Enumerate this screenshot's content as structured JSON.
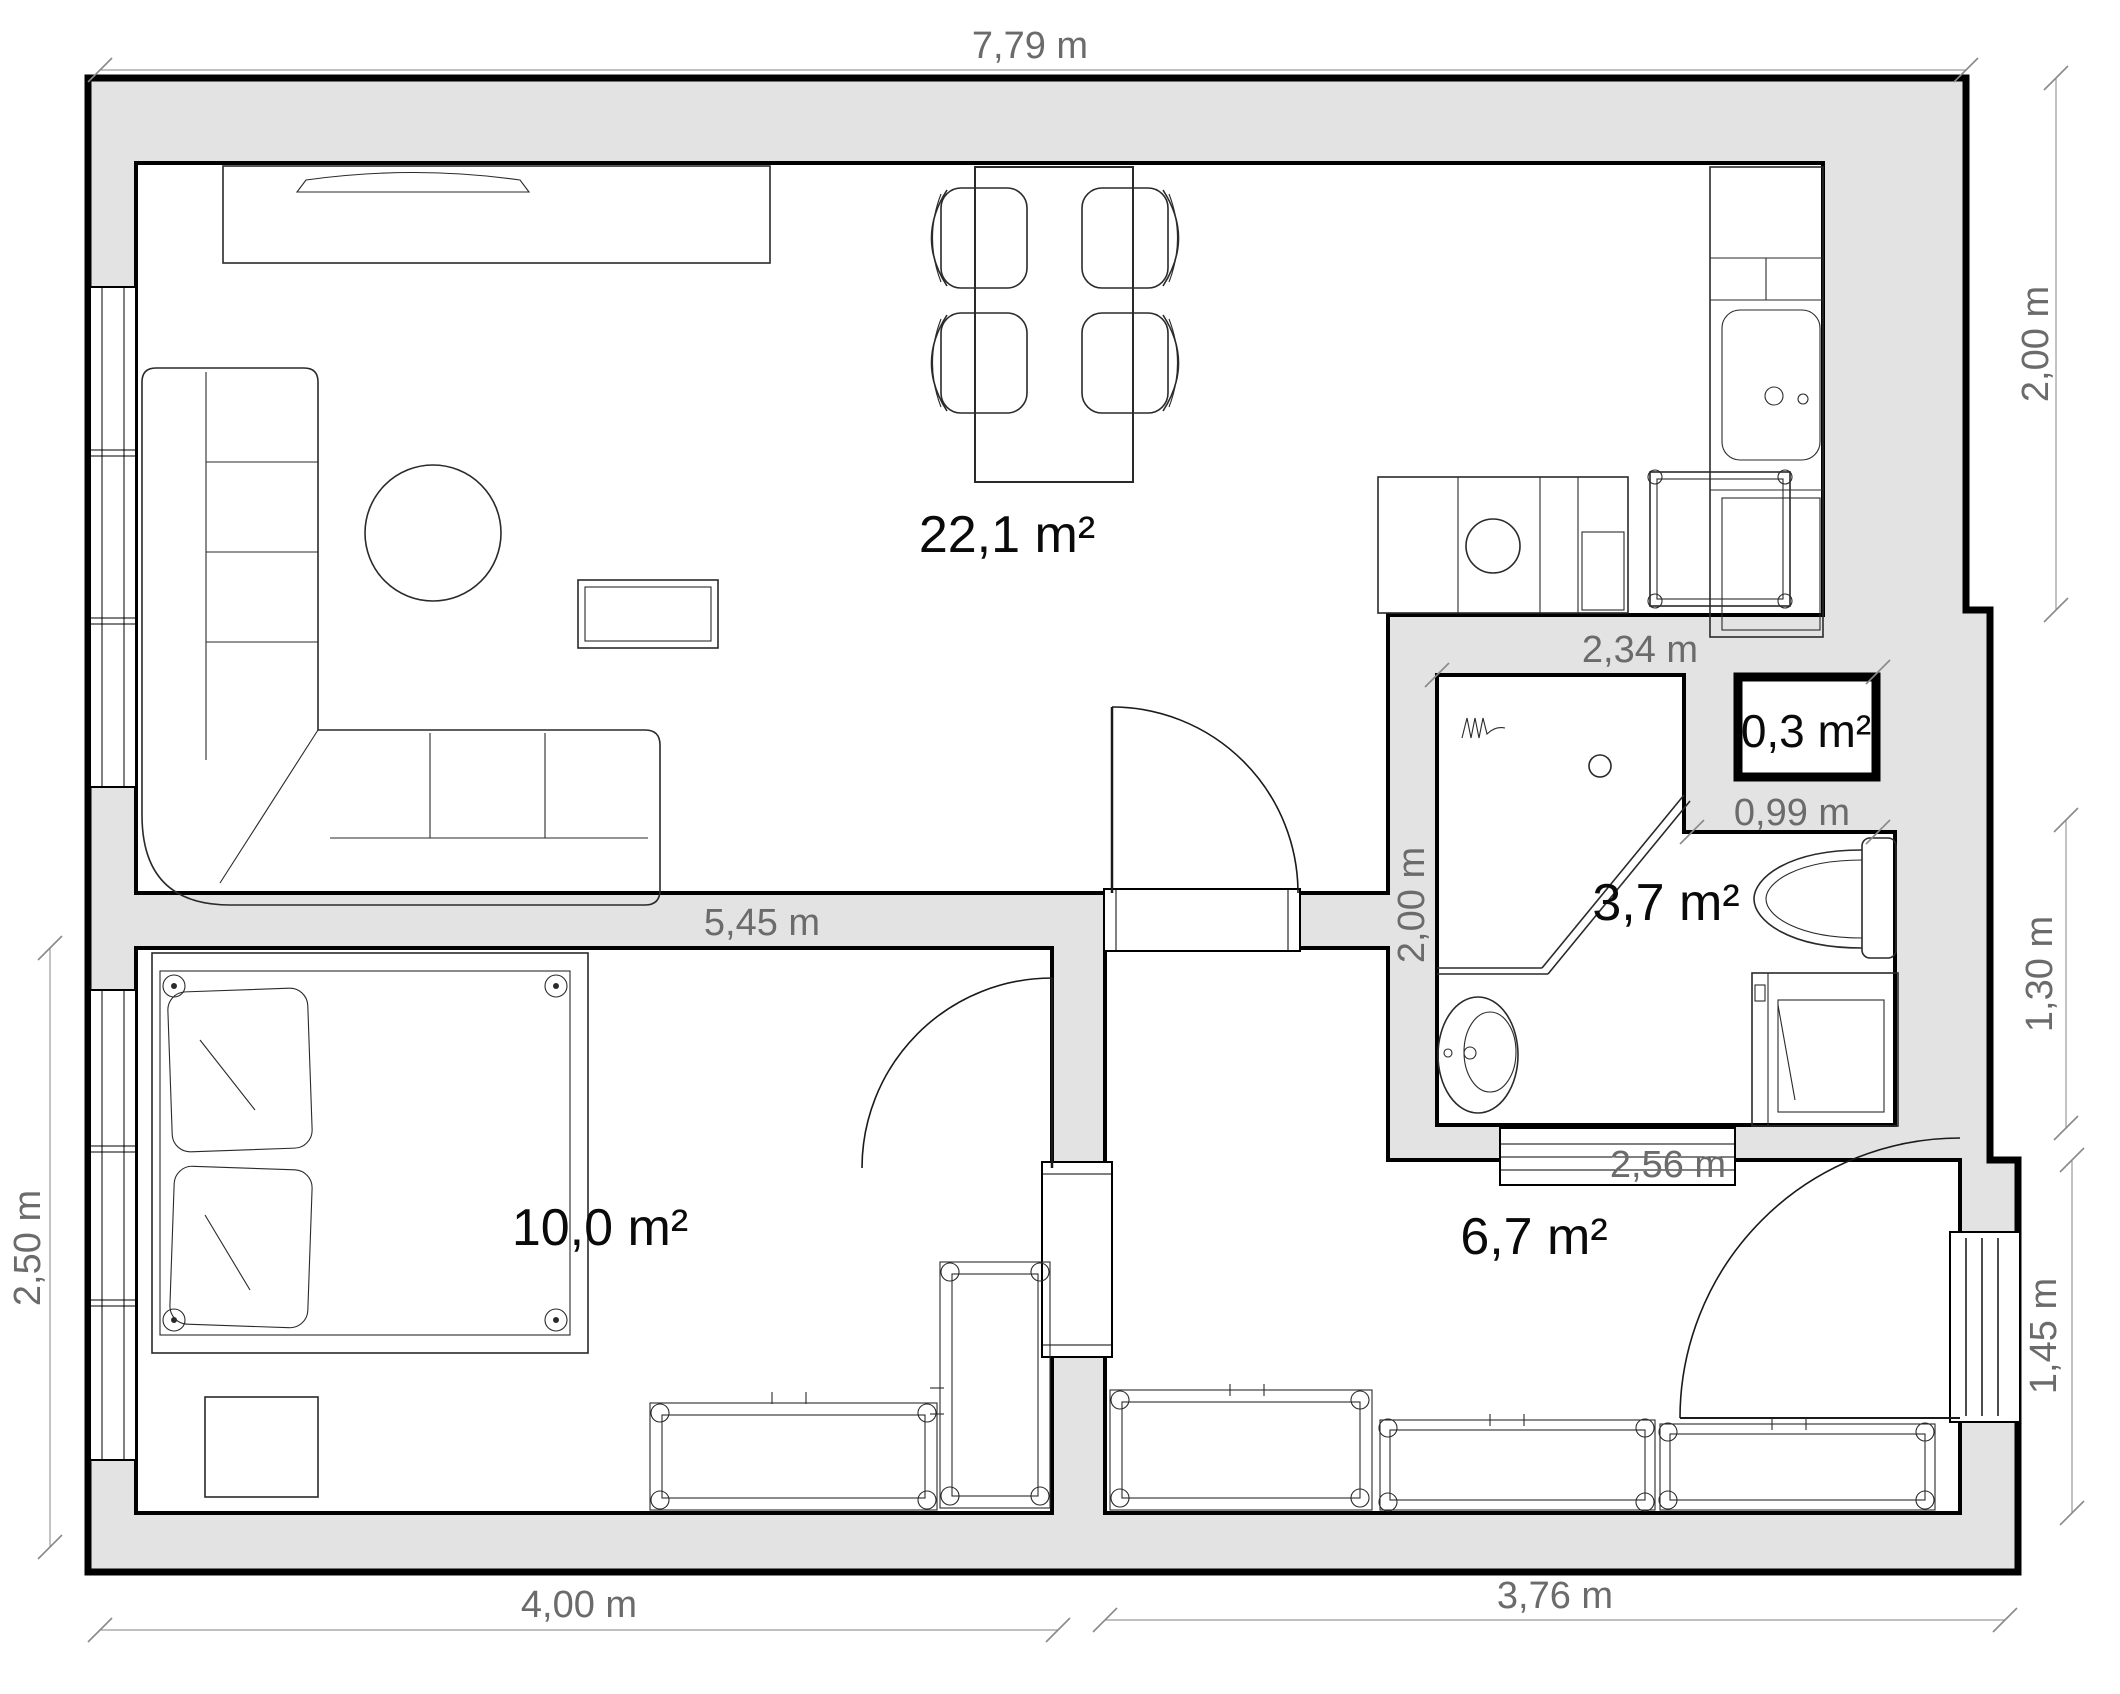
{
  "floorplan": {
    "background": "#ffffff",
    "wall_fill": "#e3e3e3",
    "line_color": "#000000",
    "dim_text_color": "#6b6b6b",
    "dim_line_color": "#9b9b9b",
    "rooms": [
      {
        "id": "living-room-kitchen",
        "area": "22,1 m²"
      },
      {
        "id": "bedroom",
        "area": "10,0 m²"
      },
      {
        "id": "bathroom",
        "area": "3,7 m²"
      },
      {
        "id": "hallway",
        "area": "6,7 m²"
      },
      {
        "id": "closet",
        "area": "0,3 m²"
      }
    ],
    "areas": {
      "living": "22,1 m²",
      "bedroom": "10,0 m²",
      "bathroom": "3,7 m²",
      "hallway": "6,7 m²",
      "closet": "0,3 m²"
    },
    "dims": {
      "top": "7,79 m",
      "right_top": "2,00 m",
      "right_mid": "1,30 m",
      "right_bottom": "1,45 m",
      "left": "2,50 m",
      "bottom_left": "4,00 m",
      "bottom_right": "3,76 m",
      "inner_wall": "5,45 m",
      "bath_top": "2,34 m",
      "closet_width": "0,99 m",
      "bath_left": "2,00 m",
      "hall_top": "2,56 m"
    }
  }
}
